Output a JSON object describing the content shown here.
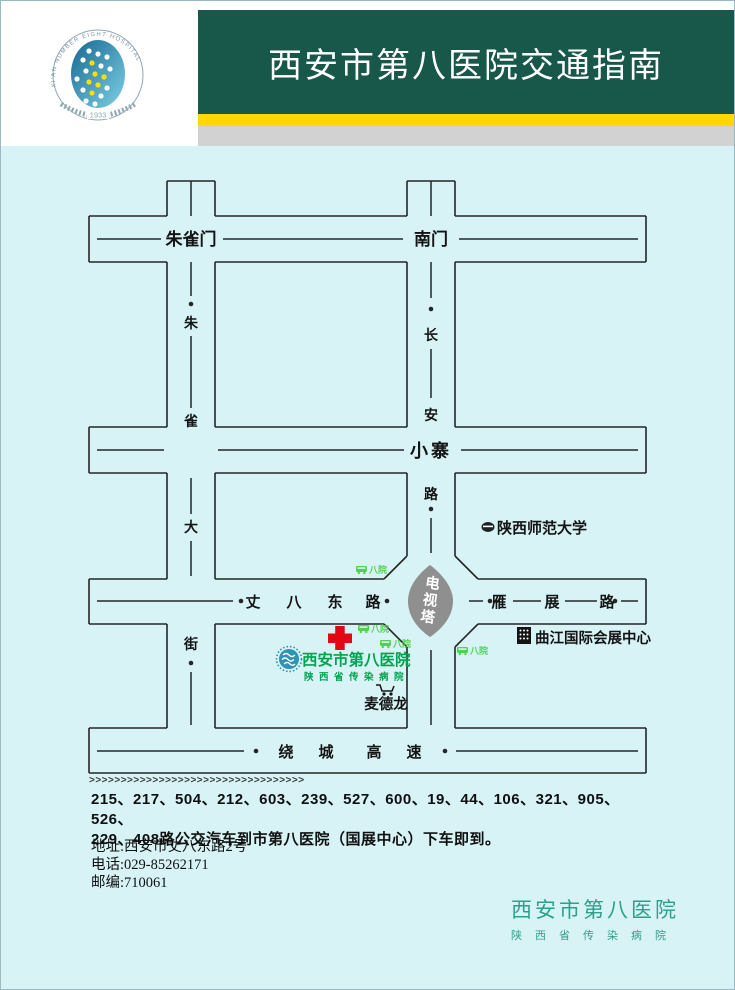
{
  "header": {
    "title": "西安市第八医院交通指南",
    "logo_arc_text": "XI'AN NUMBER EIGHT HOSPITAL",
    "logo_year": "1933",
    "colors": {
      "banner": "#18584a",
      "yellow_stripe": "#ffd800",
      "gray_stripe": "#d2d2d2"
    }
  },
  "map": {
    "bg": "#d7f3f6",
    "road_labels": {
      "zhuquemen": "朱雀门",
      "nanmen": "南门",
      "xiaozhai": "小寨",
      "zhuque_street": [
        "朱",
        "雀",
        "大",
        "街"
      ],
      "changan_road": [
        "长",
        "安",
        "路"
      ],
      "zhangba_east_road": [
        "丈",
        "八",
        "东",
        "路"
      ],
      "yanzhan_road": [
        "雁",
        "展",
        "路"
      ],
      "ring_expressway": [
        "绕",
        "城",
        "高",
        "速"
      ]
    },
    "landmarks": {
      "tv_tower": [
        "电",
        "视",
        "塔"
      ],
      "university": "陕西师范大学",
      "expo_center": "曲江国际会展中心",
      "metro": "麦德龙",
      "hospital": "西安市第八医院",
      "hospital_sub": "陕西省传染病院",
      "bus_stop": "八院"
    },
    "colors": {
      "hospital_green": "#00a44e",
      "bus_stop_green": "#4ed34e",
      "tower_gray": "#8f8f8f",
      "cross_red": "#e30613"
    }
  },
  "footer": {
    "arrows": ">>>>>>>>>>>>>>>>>>>>>>>>>>>>>>>>>>",
    "bus_line1": "215、217、504、212、603、239、527、600、19、44、106、321、905、526、",
    "bus_line2": "229、408路公交汽车到市第八医院（国展中心）下车即到。",
    "address": "地址:西安市丈八东路2号",
    "phone": "电话:029-85262171",
    "postal": "邮编:710061",
    "org": "西安市第八医院",
    "org_sub": "陕西省传染病院"
  }
}
